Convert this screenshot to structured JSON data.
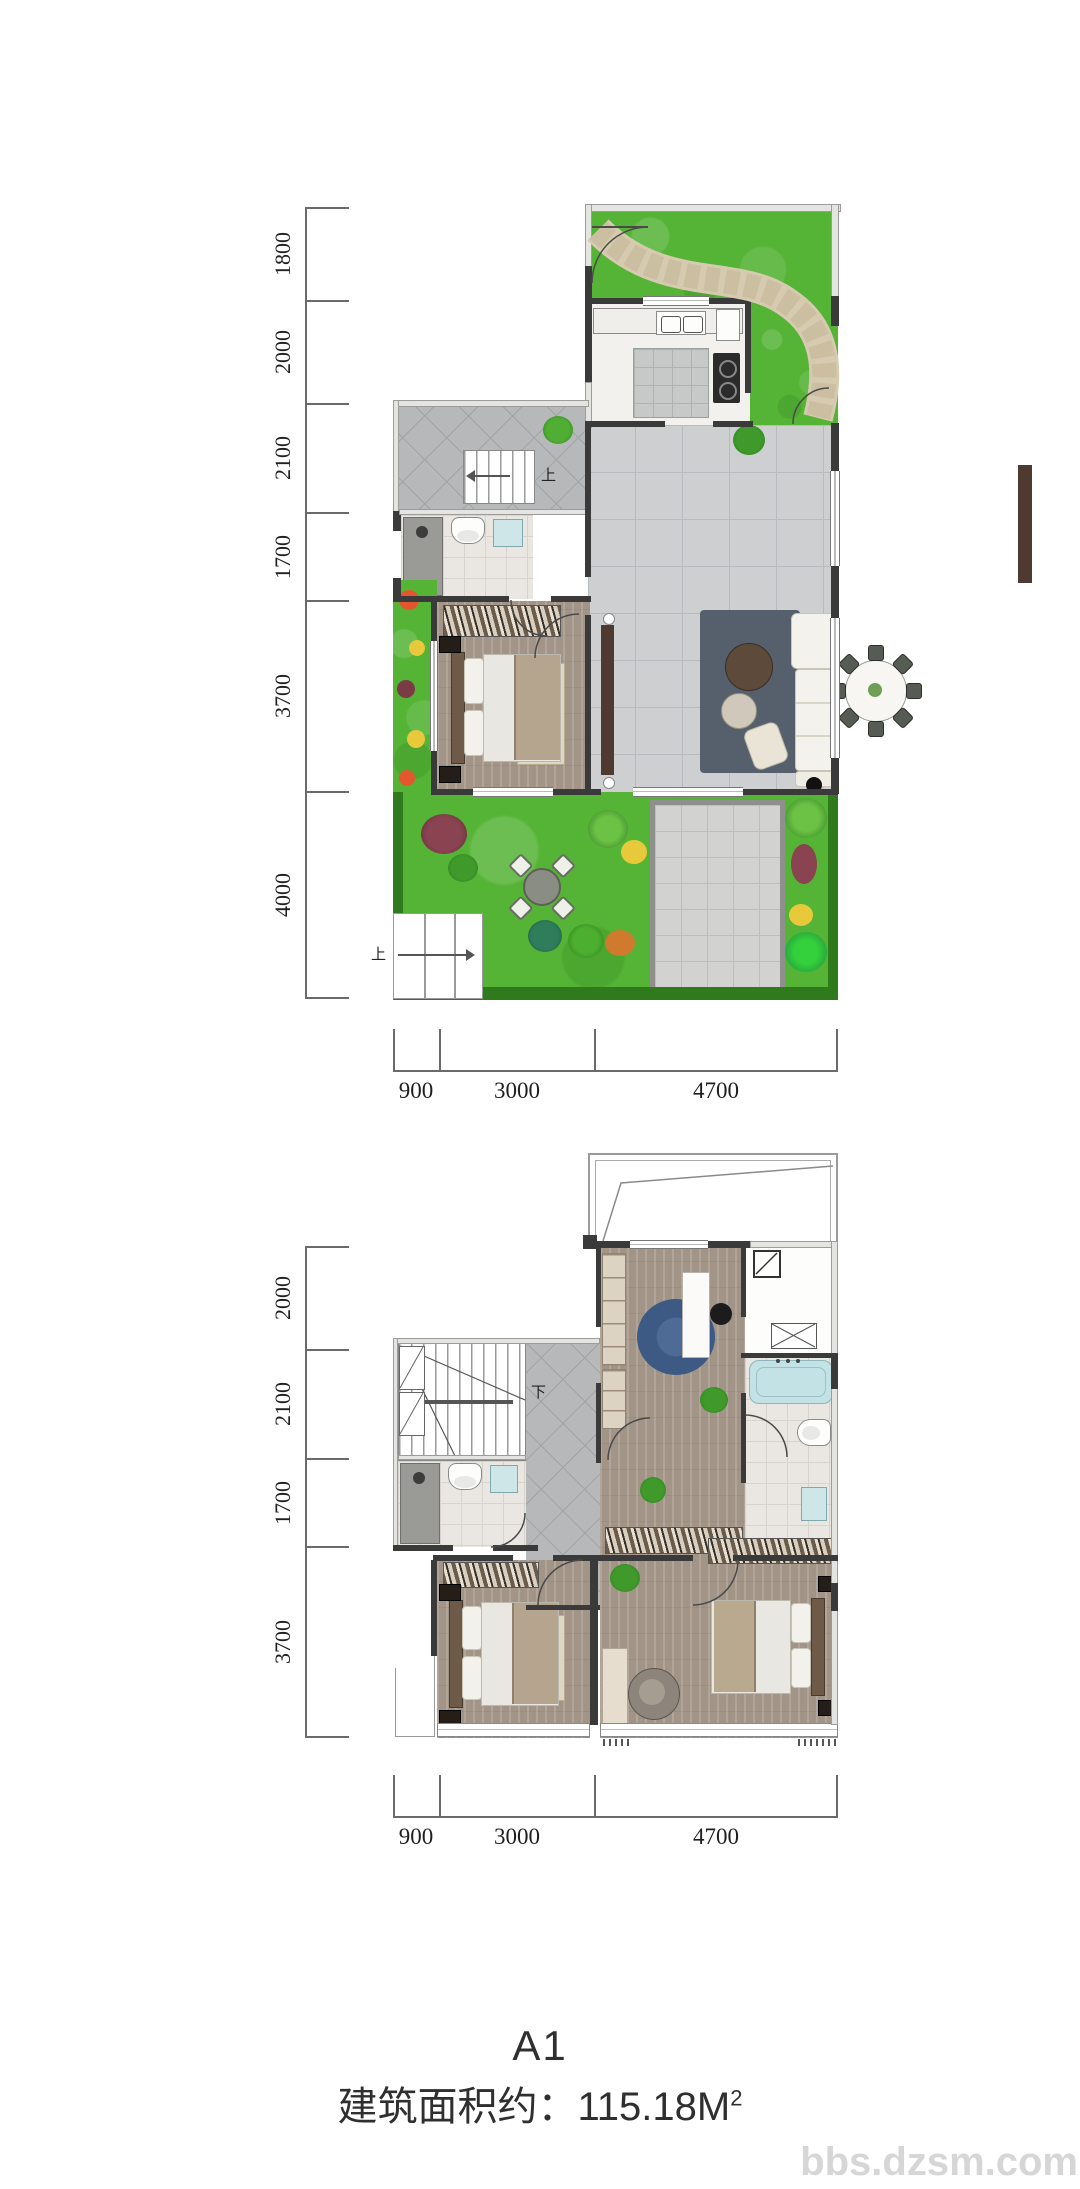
{
  "watermark": {
    "text": "bbs.dzsm.com",
    "color": "#d6d6d6"
  },
  "title": {
    "plan_code": "A1",
    "area_text": "建筑面积约：115.18M",
    "area_sup": "2"
  },
  "floor1": {
    "dims_left": [
      "1800",
      "2000",
      "2100",
      "1700",
      "3700",
      "4000"
    ],
    "dims_bottom": [
      "900",
      "3000",
      "4700"
    ],
    "stair_up": "上",
    "garden_stair_up": "上"
  },
  "floor2": {
    "dims_left": [
      "2000",
      "2100",
      "1700",
      "3700"
    ],
    "dims_bottom": [
      "900",
      "3000",
      "4700"
    ],
    "stair_down": "下"
  },
  "colors": {
    "grass": "#55b335",
    "grass_border": "#2e7a1d",
    "stone_path": "#d6cab0",
    "tile_floor": "#cdcfd1",
    "wood_floor": "#a29487",
    "wall_dark": "#3a3a3a",
    "water_blue": "#c2e2e6",
    "rug_blue": "#3c5a84",
    "dim_text": "#1f1f1f"
  }
}
